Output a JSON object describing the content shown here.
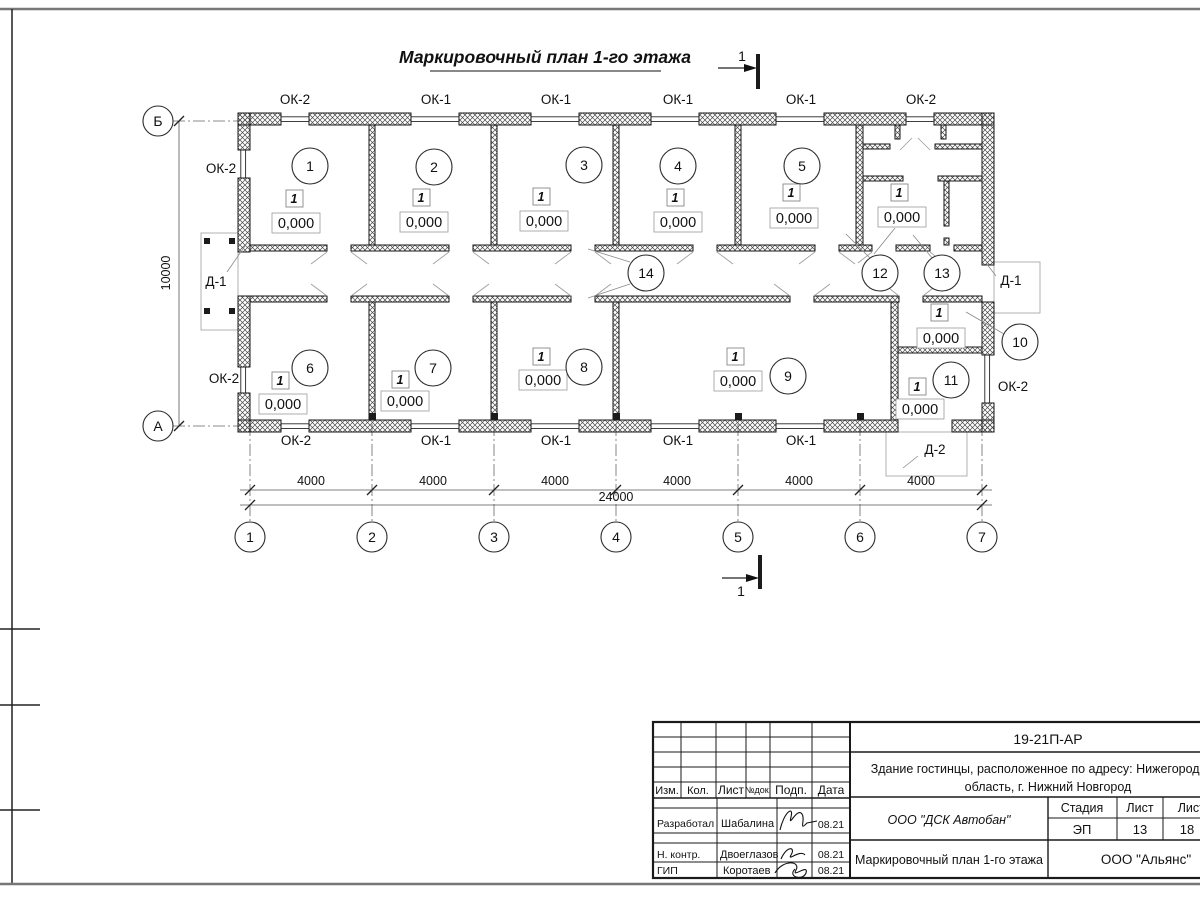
{
  "sheet": {
    "title": "Маркировочный план 1-го этажа",
    "section_label": "1"
  },
  "plan": {
    "room_numbers": [
      "1",
      "2",
      "3",
      "4",
      "5",
      "6",
      "7",
      "8",
      "9",
      "10",
      "11",
      "12",
      "13",
      "14"
    ],
    "marker": "1",
    "elevation": "0,000",
    "windows": {
      "top": [
        "ОК-2",
        "ОК-1",
        "ОК-1",
        "ОК-1",
        "ОК-1",
        "ОК-2"
      ],
      "bottom": [
        "ОК-2",
        "ОК-1",
        "ОК-1",
        "ОК-1",
        "ОК-1"
      ],
      "left_upper": "ОК-2",
      "left_lower": "ОК-2",
      "right": "ОК-2"
    },
    "doors": {
      "left": "Д-1",
      "right": "Д-1",
      "bottom": "Д-2"
    },
    "axes": {
      "columns": [
        "1",
        "2",
        "3",
        "4",
        "5",
        "6",
        "7"
      ],
      "rows": [
        "Б",
        "А"
      ]
    },
    "dimensions": {
      "bays": [
        "4000",
        "4000",
        "4000",
        "4000",
        "4000",
        "4000"
      ],
      "total": "24000",
      "depth": "10000"
    }
  },
  "titleblock": {
    "doc_number": "19-21П-АР",
    "project_line1": "Здание гостинцы, расположенное по адресу: Нижегородская",
    "project_line2": "область, г. Нижний Новгород",
    "rev_headers": [
      "Изм.",
      "Кол.",
      "Лист",
      "№док.",
      "Подп.",
      "Дата"
    ],
    "signatories": [
      {
        "role": "Разработал",
        "name": "Шабалина",
        "date": "08.21"
      },
      {
        "role": "Н. контр.",
        "name": "Двоеглазов",
        "date": "08.21"
      },
      {
        "role": "ГИП",
        "name": "Коротаев",
        "date": "08.21"
      }
    ],
    "contractor": "ООО \"ДСК Автобан\"",
    "stage_label": "Стадия",
    "sheet_label": "Лист",
    "sheets_label": "Листов",
    "stage": "ЭП",
    "sheet_number": "13",
    "sheets_total": "18",
    "drawing_title": "Маркировочный план 1-го этажа",
    "client": "ООО \"Альянс\""
  }
}
